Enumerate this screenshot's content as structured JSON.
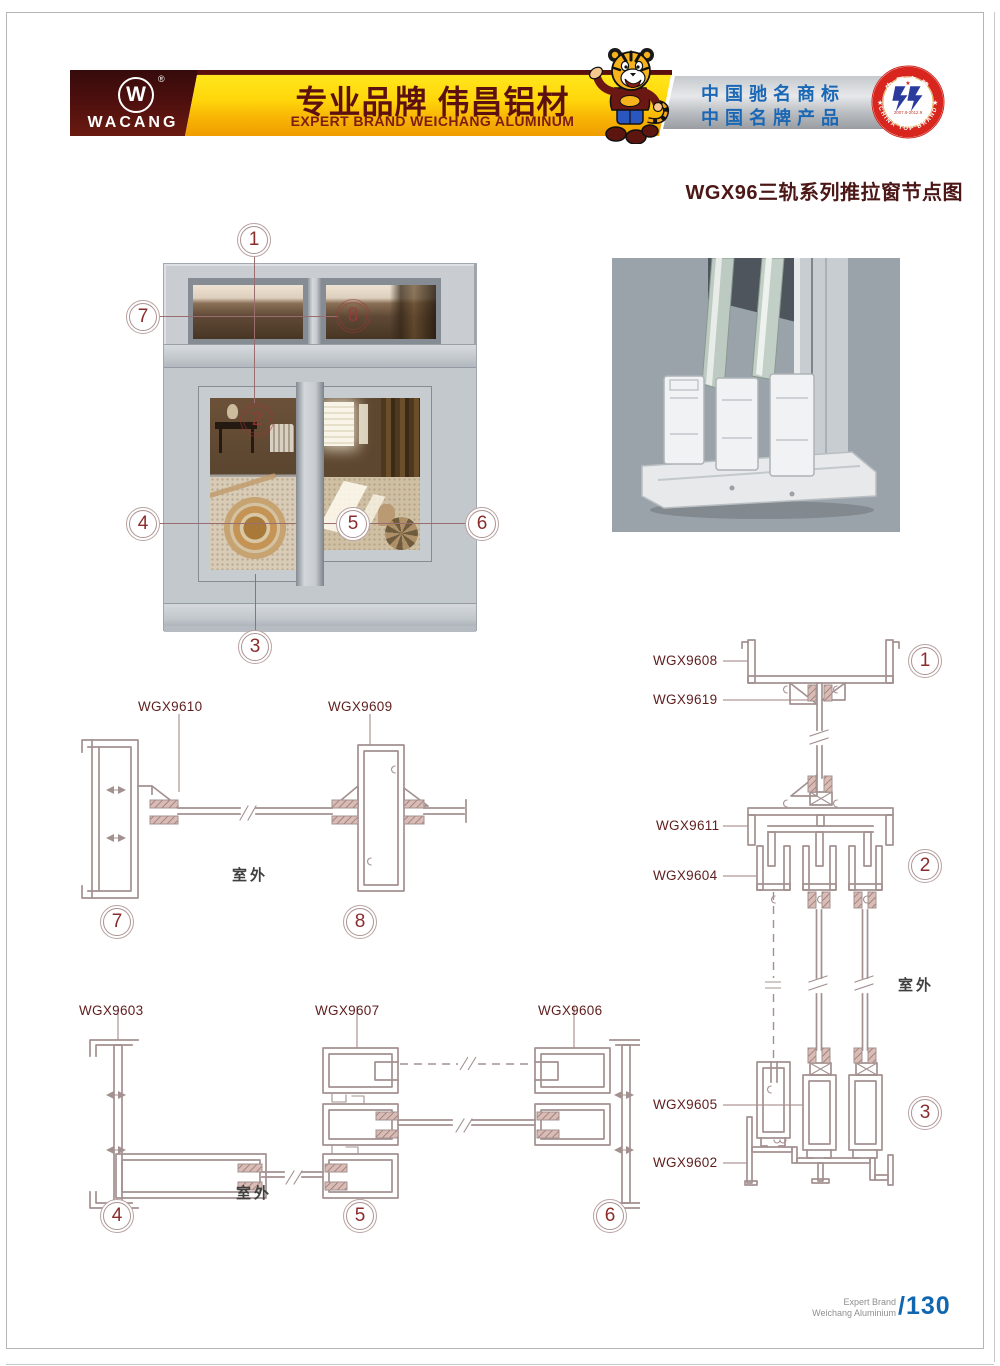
{
  "header": {
    "logo": {
      "monogram": "W",
      "registered": "®",
      "brand": "WACANG"
    },
    "banner": {
      "title_cn": "专业品牌  伟昌铝材",
      "subtitle_en": "EXPERT BRAND WEICHANG ALUMINUM"
    },
    "honors": {
      "line1": "中国驰名商标",
      "line2": "中国名牌产品"
    },
    "badge": {
      "arc_top": "中国名牌",
      "arc_bottom": "CHINA TOP BRAND",
      "dates": "2007.9-2012.9",
      "star": "★"
    }
  },
  "page_title": "WGX96三轨系列推拉窗节点图",
  "outdoor_label": "室外",
  "callouts": {
    "n1": "1",
    "n2": "2",
    "n3": "3",
    "n4": "4",
    "n5": "5",
    "n6": "6",
    "n7": "7",
    "n8": "8"
  },
  "profiles": {
    "wgx9610": "WGX9610",
    "wgx9609": "WGX9609",
    "wgx9603": "WGX9603",
    "wgx9607": "WGX9607",
    "wgx9606": "WGX9606",
    "wgx9608": "WGX9608",
    "wgx9619": "WGX9619",
    "wgx9611": "WGX9611",
    "wgx9604": "WGX9604",
    "wgx9605": "WGX9605",
    "wgx9602": "WGX9602"
  },
  "footer": {
    "brand_line1": "Expert Brand",
    "brand_line2": "Weichang Aluminium",
    "page_number": "/130"
  },
  "colors": {
    "accent_maroon": "#4a0d0d",
    "banner_yellow": "#ffd60a",
    "honor_blue": "#1a67b5",
    "title_color": "#4c1717",
    "drawing_line": "#a39190",
    "label_color": "#5f1d1d",
    "page_blue": "#1166b0"
  }
}
